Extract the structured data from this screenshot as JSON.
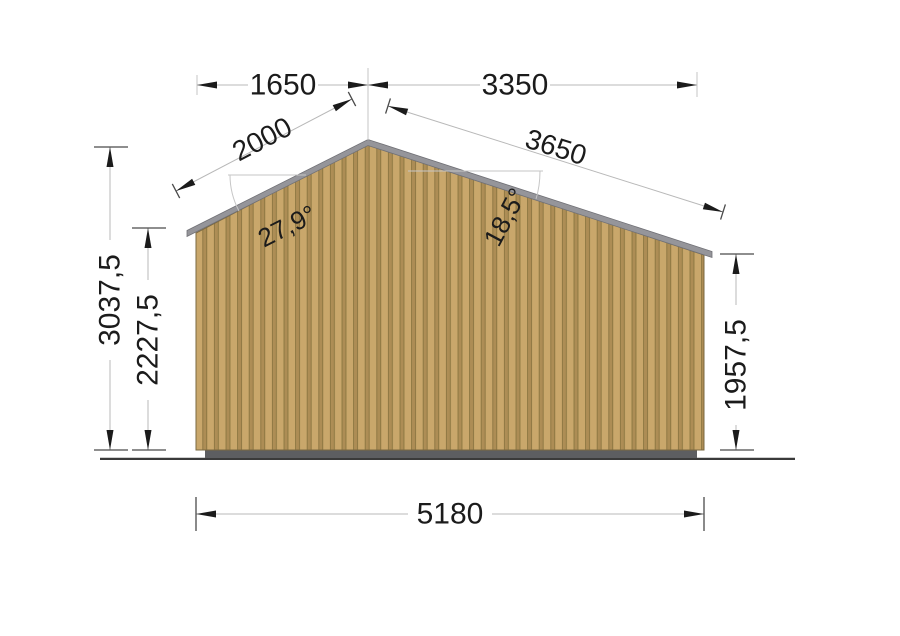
{
  "drawing": {
    "dimensions": {
      "top_width_left": "1650",
      "top_width_right": "3350",
      "roof_slope_left": "2000",
      "roof_slope_right": "3650",
      "roof_angle_left": "27,9°",
      "roof_angle_right": "18,5°",
      "total_height": "3037,5",
      "left_wall_height": "2227,5",
      "right_wall_height": "1957,5",
      "base_width": "5180"
    },
    "colors": {
      "background": "#ffffff",
      "wall_light": "#c9a76b",
      "wall_mid": "#ad8d55",
      "wall_groove": "#86713d",
      "wall_outline": "#7a6840",
      "roof": "#95959a",
      "roof_outline": "#707075",
      "foundation": "#5d5e61",
      "ground": "#3a3a3a",
      "dim_line": "#b8b8b8",
      "ext_line": "#c6c6c6",
      "tick": "#4a4a4a",
      "arrow": "#1b1b1b",
      "text": "#1b1b1b"
    }
  }
}
